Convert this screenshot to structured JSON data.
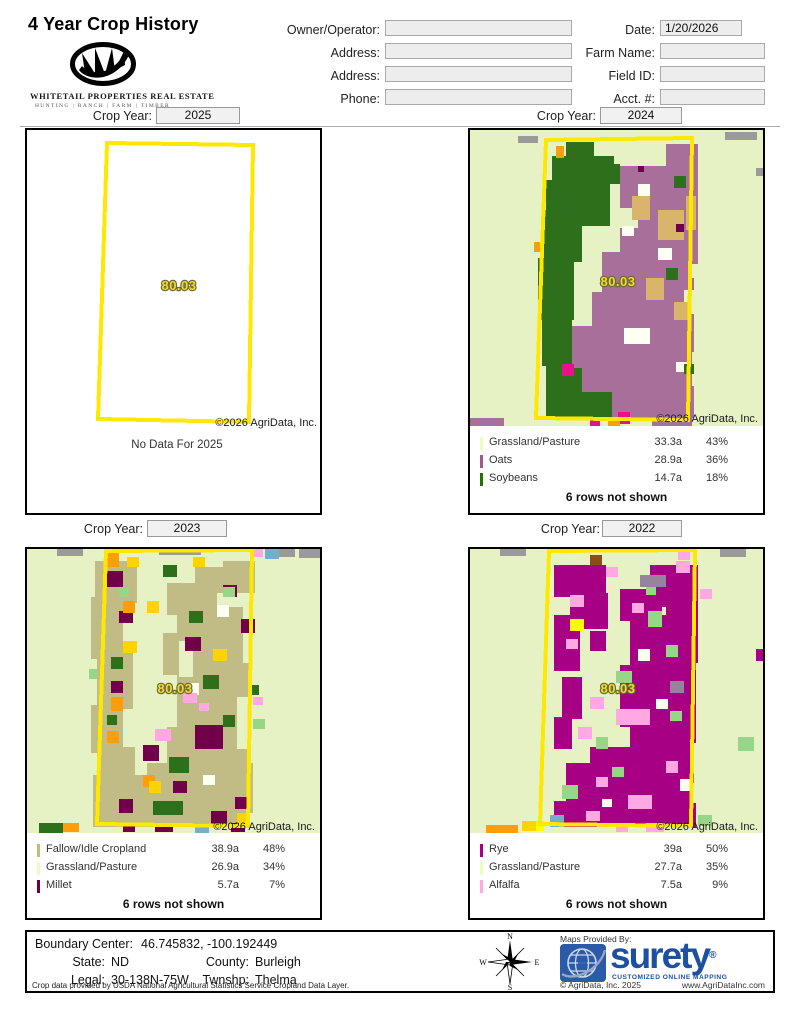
{
  "header": {
    "title": "4 Year Crop History",
    "logo": {
      "name_line": "WHITETAIL PROPERTIES REAL ESTATE",
      "tag_line": "HUNTING | RANCH | FARM | TIMBER"
    },
    "fields_left": [
      {
        "label": "Owner/Operator:",
        "value": ""
      },
      {
        "label": "Address:",
        "value": ""
      },
      {
        "label": "Address:",
        "value": ""
      },
      {
        "label": "Phone:",
        "value": ""
      }
    ],
    "fields_right": [
      {
        "label": "Date:",
        "value": "1/20/2026"
      },
      {
        "label": "Farm Name:",
        "value": ""
      },
      {
        "label": "Field ID:",
        "value": ""
      },
      {
        "label": "Acct. #:",
        "value": ""
      }
    ]
  },
  "map_colors": {
    "boundary": "#ffe800",
    "background_grassland": "#e6f2c3"
  },
  "panels": [
    {
      "crop_year_label": "Crop Year:",
      "year": "2025",
      "parcel": "80.03",
      "copyright": "©2026 AgriData, Inc.",
      "no_data": "No Data For 2025",
      "legend": [],
      "rows_not_shown": ""
    },
    {
      "crop_year_label": "Crop Year:",
      "year": "2024",
      "parcel": "80.03",
      "copyright": "©2026 AgriData, Inc.",
      "legend": [
        {
          "label": "Grassland/Pasture",
          "acres": "33.3a",
          "percent": "43%",
          "color": "#e8ffbf"
        },
        {
          "label": "Oats",
          "acres": "28.9a",
          "percent": "36%",
          "color": "#a05989"
        },
        {
          "label": "Soybeans",
          "acres": "14.7a",
          "percent": "18%",
          "color": "#267000"
        }
      ],
      "rows_not_shown": "6 rows not shown"
    },
    {
      "crop_year_label": "Crop Year:",
      "year": "2023",
      "parcel": "80.03",
      "copyright": "©2026 AgriData, Inc.",
      "legend": [
        {
          "label": "Fallow/Idle Cropland",
          "acres": "38.9a",
          "percent": "48%",
          "color": "#bfbf77"
        },
        {
          "label": "Grassland/Pasture",
          "acres": "26.9a",
          "percent": "34%",
          "color": "#e8ffbf"
        },
        {
          "label": "Millet",
          "acres": "5.7a",
          "percent": "7%",
          "color": "#700049"
        }
      ],
      "rows_not_shown": "6 rows not shown"
    },
    {
      "crop_year_label": "Crop Year:",
      "year": "2022",
      "parcel": "80.03",
      "copyright": "©2026 AgriData, Inc.",
      "legend": [
        {
          "label": "Rye",
          "acres": "39a",
          "percent": "50%",
          "color": "#a80084"
        },
        {
          "label": "Grassland/Pasture",
          "acres": "27.7a",
          "percent": "35%",
          "color": "#e8ffbf"
        },
        {
          "label": "Alfalfa",
          "acres": "7.5a",
          "percent": "9%",
          "color": "#ffa8e2"
        }
      ],
      "rows_not_shown": "6 rows not shown"
    }
  ],
  "footer": {
    "boundary_center_label": "Boundary Center:",
    "boundary_center_value": "46.745832, -100.192449",
    "state_label": "State:",
    "state_value": "ND",
    "county_label": "County:",
    "county_value": "Burleigh",
    "legal_label": "Legal:",
    "legal_value": "30-138N-75W",
    "twnshp_label": "Twnshp:",
    "twnshp_value": "Thelma",
    "data_source_note": "Crop data provided by USDA National Agricultural Statistics Service Cropland Data Layer.",
    "compass": {
      "n": "N",
      "e": "E",
      "s": "S",
      "w": "W"
    },
    "surety": {
      "maps_provided_by": "Maps Provided By:",
      "brand": "surety",
      "reg": "®",
      "tagline": "CUSTOMIZED ONLINE MAPPING",
      "copyright": "© AgriData, Inc. 2025",
      "website": "www.AgriDataInc.com",
      "brand_color": "#1d50a0"
    }
  }
}
